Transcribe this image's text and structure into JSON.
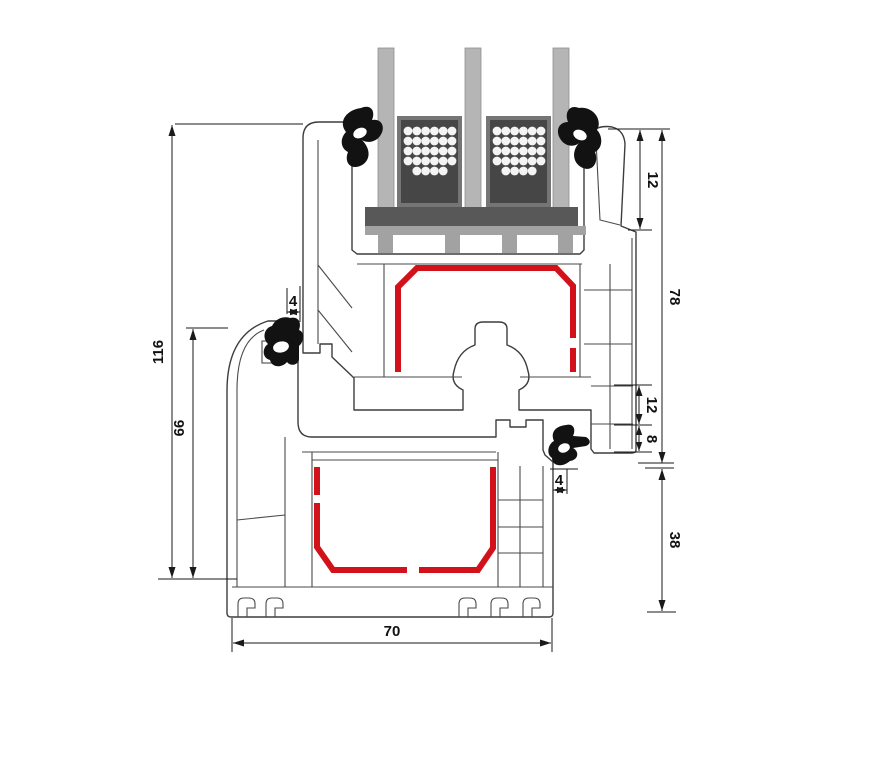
{
  "diagram": {
    "type": "window-profile-cross-section",
    "subject": "PVC window frame and sash profile section with triple glazing",
    "dimensions": {
      "total_height": "116",
      "frame_height": "66",
      "top_gasket_gap": "4",
      "glazing_rebate": "12",
      "sash_face_height": "78",
      "hardware_chamber": "12",
      "lower_chamber": "8",
      "bottom_gasket_gap": "4",
      "frame_outer_height": "38",
      "profile_depth": "70"
    },
    "glazing": {
      "pane_count": 3,
      "spacer_count": 2
    },
    "colors": {
      "steel_reinforcement": "#d2121a",
      "gasket": "#121212",
      "glass_pane": "#b5b5b5",
      "spacer_border": "#757575",
      "spacer_body": "#464646",
      "desiccant_dot": "#f4f4f4",
      "setting_block": "#585858",
      "glazing_packer": "#a2a2a2",
      "profile_outline": "#3d3d3d",
      "dimension": "#1a1a1a",
      "background": "#ffffff"
    }
  }
}
